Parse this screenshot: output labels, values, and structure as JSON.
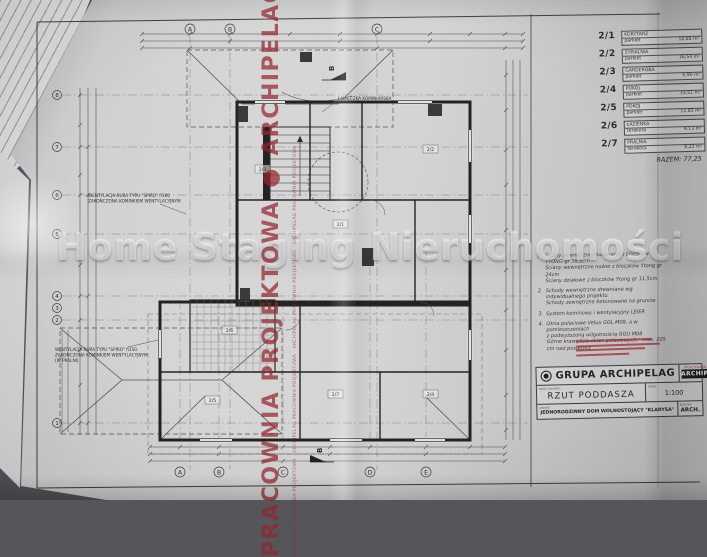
{
  "brand_color": "#9e2e34",
  "watermarks": {
    "horizontal": "Home Staging Nieruchomości",
    "vertical_main": "PRACOWNIA PROJEKTOWA ● ARCHIPELAG PRACOWNIA PROJEKTOWA ● ARCHIPELAG",
    "vertical_small": "ARCHIPELAG PRACOWNIA PROJEKTOWA · ARCHIPELAG PRACOWNIA PROJEKTOWA · ARCHIPELAG PRACOWNIA PROJEKTOWA · ARCHIPELAG PRACOWNIA PROJEKTOWA"
  },
  "schedule": {
    "rows": [
      {
        "no": "2/1",
        "name": "KORYTARZ",
        "finish": "parkiet",
        "area": "10,88 m²"
      },
      {
        "no": "2/2",
        "name": "SYPIALNIA",
        "finish": "parkiet",
        "area": "16,54 m²"
      },
      {
        "no": "2/3",
        "name": "GARDEROBA",
        "finish": "parkiet",
        "area": "5,90 m²"
      },
      {
        "no": "2/4",
        "name": "POKÓJ",
        "finish": "parkiet",
        "area": "15,51 m²"
      },
      {
        "no": "2/5",
        "name": "POKÓJ",
        "finish": "parkiet",
        "area": "12,85 m²"
      },
      {
        "no": "2/6",
        "name": "ŁAZIENKA",
        "finish": "terakota",
        "area": "9,13 m²"
      },
      {
        "no": "2/7",
        "name": "PRALNIA",
        "finish": "terakota",
        "area": "8,22 m²"
      }
    ],
    "total_label": "RAZEM:",
    "total_value": "77,25"
  },
  "notes": [
    {
      "no": "1.",
      "line1": "Ściany zewnętrzne murowane z bloczków YTONG gr 36,5cm",
      "line2": "Ściany wewnętrzne nośne z bloczków Ytong gr 24cm",
      "line3": "Ściany działowe z bloczków Ytong gr 11,5cm"
    },
    {
      "no": "2.",
      "line1": "Schody wewnętrzne drewniane wg indywidualnego projektu",
      "line2": "Schody zewnętrzne betonowane na gruncie",
      "line3": ""
    },
    {
      "no": "3.",
      "line1": "System kominowy i wentylacyjny LEIER",
      "line2": "",
      "line3": ""
    },
    {
      "no": "4.",
      "line1": "Okna połaciowe Velux GGL M08, a w pomieszczeniach",
      "line2": "z podwyższoną wilgotnością GGU M08",
      "line3": "Górne krawędzie okien połaciowych – max. 205 cm nad posadzką"
    }
  ],
  "title_block": {
    "brand": "GRUPA ARCHIPELAG",
    "logo_top": "PRACOWNIA PROJEKTOWA",
    "logo_name": "ARCHIPELAG",
    "drawing_label": "tytuł rysunku:",
    "drawing_title": "RZUT PODDASZA",
    "scale_label": "skala:",
    "scale_value": "1:100",
    "object_label": "obiekt:",
    "object_value": "JEDNORODZINNY DOM WOLNOSTOJĄCY \"KLARYSA\"",
    "trade_label": "branża:",
    "trade_value": "ARCH."
  },
  "plan": {
    "axes_top": [
      "A",
      "B",
      "C"
    ],
    "axes_bottom": [
      "A",
      "B",
      "C",
      "D",
      "E"
    ],
    "axes_left": [
      "8",
      "7",
      "6",
      "5",
      "4",
      "3",
      "2",
      "1"
    ],
    "section_label": "B",
    "vent_upper_1": "WENTYLACJA RURA TYPU \"SPIRO\" fi100",
    "vent_upper_2": "ZAKOŃCZONA KOMINKIEM WENTYLACYJNYM",
    "vent_lower_1": "WENTYLACJA RURA TYPU \"SPIRO\" fi150",
    "vent_lower_2": "ZAKOŃCZONA KOMINKIEM WENTYLACYJNYM",
    "vent_lower_3": "(W PRALNI)",
    "roof_label": "ŁAWECZKA KOMINIARSKA",
    "room_tags": [
      "2/1",
      "2/2",
      "2/3",
      "2/4",
      "2/5",
      "2/6",
      "2/7"
    ]
  }
}
